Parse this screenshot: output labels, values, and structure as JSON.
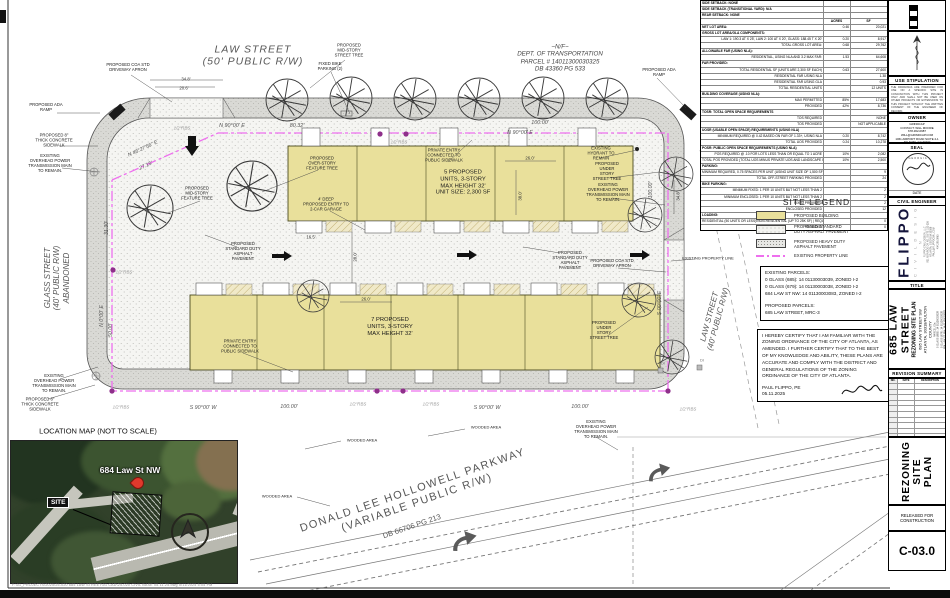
{
  "colors": {
    "building": "#e9e09b",
    "property_line": "#ee6fee",
    "pin": "#8e2f8a",
    "band": "#dadad6"
  },
  "site_table": {
    "rows": [
      {
        "l": "SIDE SETBACK: NONE",
        "a": "",
        "s": "",
        "h": 1
      },
      {
        "l": "SIDE SETBACK (TRANSITIONAL YARD): N/A",
        "a": "",
        "s": "",
        "h": 1
      },
      {
        "l": "REAR SETBACK: NONE",
        "a": "",
        "s": "",
        "h": 1
      },
      {
        "l": "",
        "a": "ACRES",
        "s": "SF",
        "h": 1,
        "c": 1
      },
      {
        "l": "NET LOT AREA:",
        "a": "0.46",
        "s": "20,021",
        "h": 1
      },
      {
        "l": "GROSS LOT AREA/GLA COMPONENTS:",
        "a": "",
        "s": "",
        "h": 1
      },
      {
        "l": "LAW 1: 190.3 AT X 25', LAW 2: 100 AT X 20', GLASS: 188.45 T X 20'",
        "a": "0.20",
        "s": "8,917"
      },
      {
        "l": "TOTAL GROSS LOT AREA:",
        "a": "0.68",
        "s": "29,762"
      },
      {
        "l": "ALLOWABLE FAR (USING NLA):",
        "a": "",
        "s": "",
        "h": 1
      },
      {
        "l": "RESIDENTIAL, USING NLA AND 3.2 MAX FAR:",
        "a": "1.53",
        "s": "64,608"
      },
      {
        "l": "FAR PROVIDED:",
        "a": "",
        "s": "",
        "h": 1
      },
      {
        "l": "TOTAL RESIDENTIAL SF (UNITS ARE 2,300 SF EACH)",
        "a": "0.63",
        "s": "27,600"
      },
      {
        "l": "RESIDENTIAL FAR USING NLA",
        "a": "",
        "s": "1.38"
      },
      {
        "l": "RESIDENTIAL FAR USING GLA",
        "a": "",
        "s": "0.93"
      },
      {
        "l": "TOTAL RESIDENTIAL UNITS",
        "a": "",
        "s": "12 UNITS"
      },
      {
        "l": "BUILDING COVERAGE (USING NLA):",
        "a": "",
        "s": "",
        "h": 1
      },
      {
        "l": "MAX PERMITTED",
        "a": "85%",
        "s": "17,683"
      },
      {
        "l": "PROVIDED",
        "a": "42%",
        "s": "8,736"
      },
      {
        "l": "TOSR: TOTAL OPEN SPACE REQUIREMENTS",
        "a": "",
        "s": "",
        "h": 1
      },
      {
        "l": "TOS REQUIRED",
        "a": "",
        "s": "NONE"
      },
      {
        "l": "TOS PROVIDED",
        "a": "",
        "s": "NOT APPLICABLE"
      },
      {
        "l": "UOSR (USABLE OPEN SPACE) REQUIREMENTS (USING NLA)",
        "a": "",
        "s": "",
        "h": 1
      },
      {
        "l": "MINIMUM REQUIRED @ 0.42 BASED ON FAR OF 1.33+, USING NLA",
        "a": "0.20",
        "s": "8,742"
      },
      {
        "l": "TOTAL UOS PROVIDED",
        "a": "0.24",
        "s": "10,278"
      },
      {
        "l": "POSR: PUBLIC OPEN SPACE REQUIREMENTS (USING NLA)",
        "a": "",
        "s": "",
        "h": 1
      },
      {
        "l": "POS REQUIRED @ .10 FOR LOTS LESS THAN OR EQUAL TO 1 ACRE",
        "a": "10%",
        "s": "2,082"
      },
      {
        "l": "TOTAL POS PROVIDED (TOTAL UOS MINUS PRIVATE UOS AND LANDSCAPE IN R.O.W.)",
        "a": "10%",
        "s": "2,500"
      },
      {
        "l": "PARKING:",
        "a": "",
        "s": "",
        "h": 1
      },
      {
        "l": "MINIMUM REQUIRED, 0.75 SPACES PER UNIT (USING UNIT SIZE OF 1,500 SF OR MORE)",
        "a": "",
        "s": "9"
      },
      {
        "l": "TOTAL OFF-STREET PARKING PROVIDED",
        "a": "",
        "s": "24"
      },
      {
        "l": "BIKE PARKING:",
        "a": "",
        "s": "",
        "h": 1
      },
      {
        "l": "MINIMUM FIXED: 1 PER 10 UNITS BUT NOT LESS THAN 2",
        "a": "",
        "s": "2"
      },
      {
        "l": "MINIMUM ENCLOSED: 1 PER 10 UNITS BUT NOT LESS THAN 2",
        "a": "",
        "s": "2"
      },
      {
        "l": "FIXED PROVIDED",
        "a": "",
        "s": "2"
      },
      {
        "l": "ENCLOSED PROVIDED",
        "a": "",
        "s": "12"
      },
      {
        "l": "LOADING:",
        "a": "",
        "s": "",
        "h": 1
      },
      {
        "l": "RESIDENTIAL (50 UNITS OR LESS)/NON-RESIDENTIAL (UP TO 25K SF) | REQUIRED",
        "a": "",
        "s": "0"
      },
      {
        "l": "PROVIDED",
        "a": "",
        "s": "0"
      }
    ]
  },
  "legend": {
    "title": "SITE LEGEND",
    "items": [
      {
        "label": "PROPOSED BUILDING"
      },
      {
        "label": "PROPOSED STANDARD\nDUTY ASPHALT PAVEMENT"
      },
      {
        "label": "PROPOSED HEAVY DUTY\nASPHALT PAVEMENT"
      },
      {
        "label": "EXISTING PROPERTY LINE"
      }
    ],
    "parcels": [
      "EXISTING PARCELS:",
      "0 GLASS (685): 14 01130003039, ZONED I-2",
      "0 GLASS (679): 14 01130003038, ZONED I-2",
      "684 LAW ST NW: 14 01130003083, ZONED I-2",
      "",
      "PROPOSED PARCELS:",
      "685 LAW STREET, MRC-3"
    ],
    "cert_text": "I HEREBY CERTIFY THAT I AM FAMILIAR WITH THE ZONING ORDINANCE OF THE CITY OF ATLANTA, AS AMENDED. I FURTHER CERTIFY THAT TO THE BEST OF MY KNOWLEDGE AND ABILITY, THESE PLANS ARE ACCURATE AND COMPLY WITH THE DISTRICT AND GENERAL REGULATIONS OF THE ZONING ORDINANCE OF THE CITY OF ATLANTA.",
    "cert_name": "PAUL FLIPPO, PE",
    "cert_date": "05.11.2025"
  },
  "location_map": {
    "title": "LOCATION MAP (NOT TO SCALE)",
    "street_label": "684 Law St NW",
    "site_label": "SITE",
    "file_path": "F:\\01_PROJECTS\\2025\\25-020      685 LAW STREET\\01 CAD\\25-020 CIVIL BASE 05.11.25.dwg      5/11/2025 5:05 PM"
  },
  "sidebar": {
    "graphic": {
      "label": "GRAPHIC",
      "ticks": "10      0",
      "scale": "1 inch = 20 ft."
    },
    "use_stipulation": {
      "title": "USE STIPULATION",
      "body": "THE DRAWINGS ARE PREPARED FOR USE ON A SPECIFIC SITE IN CONJUNCTION WITH THIS PROJECT ONLY AND SHALL NOT BE USED ON OTHER PROJECTS OR EXTENSIONS TO THIS PROJECT WITHOUT THE WRITTEN CONSENT OF THE ENGINEER OF RECORD."
    },
    "owner": {
      "title": "OWNER",
      "lines": [
        "GRINDCAP",
        "CONTACT: WILL MOORE",
        "678-362-0987",
        "WILL@GRINDCAP.COM",
        "1061 AIRPORT ROAD SUITE 2-1",
        "ATLANTA, GA 30344"
      ]
    },
    "seal": {
      "title": "SEAL",
      "state": "GEORGIA",
      "date_label": "DATE"
    },
    "engineer": {
      "title": "CIVIL ENGINEER",
      "firm": "FLIPPO",
      "sub": "C I V I L D E S I G N",
      "lines": [
        "FLIPPO CIVIL DESIGN, LLC",
        "931 MONROE DR NE, SUITE 102-326",
        "ATLANTA, GEORGIA 30308",
        "PAUL@FLIPPOCIVIL.COM",
        "404.295.0963"
      ]
    },
    "title_label": "TITLE",
    "project": {
      "name": "685 LAW STREET",
      "subtitle": "REZONING SITE PLAN",
      "address": "685 LAW STREET SW",
      "city": "ATLANTA, 30318/FULTON COUNTY",
      "parcels": [
        "PARCEL IDs:",
        "0 GLASS (685): 14 01130003039",
        "0 GLASS (679): 14 01130003038",
        "684 LAW ST NW: 14 01130003083"
      ]
    },
    "revision": {
      "title": "REVISION SUMMARY",
      "cols": [
        "NO.",
        "DATE",
        "DESCRIPTION"
      ]
    },
    "sheet_name": "REZONING\nSITE PLAN",
    "released": "RELEASED FOR\nCONSTRUCTION",
    "number": "C-03.0"
  },
  "plan": {
    "callouts": [
      {
        "n": "law-street-50-label",
        "t": "LAW STREET\n(50' PUBLIC R/W)",
        "x": 253,
        "y": 56,
        "fs": 10.5,
        "c": "#555",
        "i": 1,
        "ls": 1
      },
      {
        "n": "glass-street-label",
        "t": "GLASS STREET\n(40' PUBLIC R/W)\nABANDONED",
        "x": 57,
        "y": 278,
        "fs": 8,
        "c": "#555",
        "i": 1,
        "r": -90
      },
      {
        "n": "law-street-40-label",
        "t": "LAW STREET\n(40' PUBLIC R/W)",
        "x": 714,
        "y": 318,
        "fs": 8,
        "c": "#555",
        "i": 1,
        "r": -75
      },
      {
        "n": "dot-parcel-label",
        "t": "~N/F~\nDEPT. OF TRANSPORTATION\nPARCEL # 14011300030325\nDB 43360 PG 533",
        "x": 560,
        "y": 58,
        "fs": 6.2,
        "c": "#444",
        "i": 1
      },
      {
        "n": "parkway-label",
        "t": "DONALD LEE HOLLOWELL PARKWAY\n(VARIABLE PUBLIC R/W)",
        "x": 415,
        "y": 497,
        "fs": 11,
        "c": "#555",
        "r": -19,
        "ls": 1.5
      },
      {
        "n": "parkway-db-label",
        "t": "DB 66706 PG 213",
        "x": 412,
        "y": 527,
        "fs": 7.5,
        "c": "#555",
        "r": -19
      },
      {
        "n": "location-map-title",
        "t": "LOCATION MAP (NOT TO SCALE)",
        "x": 98,
        "y": 432,
        "fs": 7.5,
        "c": "#111"
      },
      {
        "n": "bearing-n90-1",
        "t": "N 90°00' E",
        "x": 232,
        "y": 126,
        "fs": 5.4,
        "c": "#555",
        "i": 1
      },
      {
        "n": "dist-8032",
        "t": "80.32'",
        "x": 297,
        "y": 126,
        "fs": 5.4,
        "c": "#555",
        "i": 1
      },
      {
        "n": "bearing-n90-2",
        "t": "N 90°00' E",
        "x": 520,
        "y": 133,
        "fs": 5.4,
        "c": "#555",
        "i": 1
      },
      {
        "n": "dist-100-top",
        "t": "100.00'",
        "x": 540,
        "y": 123,
        "fs": 5.4,
        "c": "#555",
        "i": 1
      },
      {
        "n": "bearing-n46",
        "t": "N 46°27'56\" E",
        "x": 143,
        "y": 149,
        "fs": 5.2,
        "c": "#555",
        "i": 1,
        "r": -25
      },
      {
        "n": "dist-2715",
        "t": "27.15'",
        "x": 146,
        "y": 166,
        "fs": 5.2,
        "c": "#555",
        "i": 1,
        "r": -25
      },
      {
        "n": "dist-3130",
        "t": "31.30'",
        "x": 107,
        "y": 228,
        "fs": 5.2,
        "c": "#555",
        "i": 1,
        "r": -90
      },
      {
        "n": "bearing-n0",
        "t": "N 0°00' E",
        "x": 102,
        "y": 316,
        "fs": 5.2,
        "c": "#555",
        "i": 1,
        "r": -90
      },
      {
        "n": "dist-5000",
        "t": "50.00'",
        "x": 111,
        "y": 330,
        "fs": 5.2,
        "c": "#555",
        "i": 1,
        "r": -90
      },
      {
        "n": "bearing-s90-1",
        "t": "S 90°00' W",
        "x": 203,
        "y": 408,
        "fs": 5.4,
        "c": "#555",
        "i": 1
      },
      {
        "n": "dist-100-sw1",
        "t": "100.00'",
        "x": 289,
        "y": 407,
        "fs": 5.4,
        "c": "#555",
        "i": 1
      },
      {
        "n": "bearing-s90-2",
        "t": "S 90°00' W",
        "x": 487,
        "y": 408,
        "fs": 5.4,
        "c": "#555",
        "i": 1
      },
      {
        "n": "dist-100-sw2",
        "t": "100.00'",
        "x": 580,
        "y": 407,
        "fs": 5.4,
        "c": "#555",
        "i": 1
      },
      {
        "n": "bearing-s0",
        "t": "S 00°00' E",
        "x": 660,
        "y": 303,
        "fs": 5.2,
        "c": "#555",
        "i": 1,
        "r": -90
      },
      {
        "n": "dist-100-east",
        "t": "100.00'",
        "x": 651,
        "y": 190,
        "fs": 5.2,
        "c": "#555",
        "i": 1,
        "r": -90
      },
      {
        "n": "rbs-1",
        "t": "1/2\"RBS",
        "x": 182,
        "y": 128,
        "fs": 4.4,
        "c": "#999",
        "i": 1
      },
      {
        "n": "rbs-2",
        "t": "1/2\"RBS",
        "x": 399,
        "y": 142,
        "fs": 4.4,
        "c": "#999",
        "i": 1
      },
      {
        "n": "rbs-3",
        "t": "1/2\"RBS",
        "x": 124,
        "y": 272,
        "fs": 4.4,
        "c": "#999",
        "i": 1
      },
      {
        "n": "rbs-4",
        "t": "1/2\"RBS",
        "x": 121,
        "y": 407,
        "fs": 4.4,
        "c": "#999",
        "i": 1
      },
      {
        "n": "rbs-5",
        "t": "1/2\"RBS",
        "x": 358,
        "y": 404,
        "fs": 4.4,
        "c": "#999",
        "i": 1
      },
      {
        "n": "rbs-6",
        "t": "1/2\"RBS",
        "x": 431,
        "y": 404,
        "fs": 4.4,
        "c": "#999",
        "i": 1
      },
      {
        "n": "rbs-7",
        "t": "1/2\"RBS",
        "x": 688,
        "y": 409,
        "fs": 4.4,
        "c": "#999",
        "i": 1
      },
      {
        "n": "dim-348-top",
        "t": "34.8'",
        "x": 186,
        "y": 79,
        "fs": 4.3,
        "c": "#333"
      },
      {
        "n": "dim-206",
        "t": "20.6'",
        "x": 184,
        "y": 88,
        "fs": 4.3,
        "c": "#333"
      },
      {
        "n": "dim-260-top",
        "t": "26.0'",
        "x": 530,
        "y": 158,
        "fs": 4.3,
        "c": "#333"
      },
      {
        "n": "dim-380",
        "t": "38.0'",
        "x": 520,
        "y": 196,
        "fs": 4.3,
        "c": "#333",
        "r": -90
      },
      {
        "n": "dim-165",
        "t": "16.5'",
        "x": 311,
        "y": 237,
        "fs": 4.3,
        "c": "#333"
      },
      {
        "n": "dim-280",
        "t": "28.0'",
        "x": 355,
        "y": 257,
        "fs": 4.3,
        "c": "#333",
        "r": -90
      },
      {
        "n": "dim-260-bot",
        "t": "26.0'",
        "x": 366,
        "y": 299,
        "fs": 4.3,
        "c": "#333"
      },
      {
        "n": "dim-348-right",
        "t": "34.8'",
        "x": 678,
        "y": 196,
        "fs": 4.3,
        "c": "#333",
        "r": -90
      },
      {
        "n": "di-1",
        "t": "DI",
        "x": 663,
        "y": 364,
        "fs": 4,
        "c": "#777"
      },
      {
        "n": "di-2",
        "t": "DI",
        "x": 702,
        "y": 361,
        "fs": 4,
        "c": "#777"
      },
      {
        "n": "callout-driveway-apron-top",
        "t": "PROPOSED COA STD\nDRIVEWAY APRON",
        "x": 128,
        "y": 68
      },
      {
        "n": "callout-midstory-street-tree",
        "t": "PROPOSED\nMID-STORY\nSTREET TREE",
        "x": 349,
        "y": 51
      },
      {
        "n": "callout-bike-parking",
        "t": "FIXED BIKE\nPARKING (2)",
        "x": 330,
        "y": 67
      },
      {
        "n": "callout-ada-ramp-left",
        "t": "PROPOSED ADA\nRAMP",
        "x": 46,
        "y": 108
      },
      {
        "n": "callout-ada-ramp-right",
        "t": "PROPOSED ADA\nRAMP",
        "x": 659,
        "y": 73
      },
      {
        "n": "callout-sidewalk-nw",
        "t": "PROPOSED 8\"\nTHICK CONCRETE\nSIDEWALK",
        "x": 54,
        "y": 141
      },
      {
        "n": "callout-power-nw",
        "t": "EXISTING\nOVERHEAD POWER\nTRANSMISSION MAIN\nTO REMAIN.",
        "x": 50,
        "y": 164
      },
      {
        "n": "callout-midstory-feature-tree",
        "t": "PROPOSED\nMID-STORY\nFEATURE TREE",
        "x": 197,
        "y": 194
      },
      {
        "n": "callout-overstory-feature-tree",
        "t": "PROPOSED\nOVER-STORY\nFEATURE TREE",
        "x": 322,
        "y": 164
      },
      {
        "n": "callout-private-entry-top",
        "t": "PRIVATE ENTRY\nCONNECTED TO\nPUBLIC SIDEWALK",
        "x": 444,
        "y": 156
      },
      {
        "n": "label-5-units",
        "t": "5 PROPOSED\nUNITS, 3-STORY\nMAX HEIGHT 32'\nUNIT SIZE: 2,300 SF",
        "x": 463,
        "y": 183,
        "fs": 5.8
      },
      {
        "n": "callout-hydrant",
        "t": "EXISTING\nHYDRANT TO\nREMAIN",
        "x": 601,
        "y": 154
      },
      {
        "n": "callout-understory-tree-ne",
        "t": "PROPOSED\nUNDER\nSTORY\nSTREET TREE",
        "x": 607,
        "y": 172
      },
      {
        "n": "callout-power-ne",
        "t": "EXISTING\nOVERHEAD POWER\nTRANSMISSION MAIN\nTO REMAIN.",
        "x": 608,
        "y": 193
      },
      {
        "n": "callout-garage-entry",
        "t": "4' DEEP\nPROPOSED ENTRY TO\n2-CAR GARAGE",
        "x": 326,
        "y": 205
      },
      {
        "n": "callout-asphalt-west",
        "t": "PROPOSED\nSTANDARD DUTY\nASPHALT\nPAVEMENT",
        "x": 243,
        "y": 252
      },
      {
        "n": "callout-asphalt-east",
        "t": "PROPOSED\nSTANDARD DUTY\nASPHALT\nPAVEMENT",
        "x": 570,
        "y": 261
      },
      {
        "n": "callout-driveway-apron-right",
        "t": "PROPOSED COA STD\nDRIVEWAY APRON",
        "x": 612,
        "y": 264
      },
      {
        "n": "callout-property-line",
        "t": "EXISTING PROPERTY LINE",
        "x": 708,
        "y": 259,
        "fs": 4
      },
      {
        "n": "label-7-units",
        "t": "7 PROPOSED\nUNITS, 3-STORY\nMAX HEIGHT 32'",
        "x": 390,
        "y": 327,
        "fs": 5.8
      },
      {
        "n": "callout-private-entry-bottom",
        "t": "PRIVATE ENTRY\nCONNECTED TO\nPUBLIC SIDEWALK",
        "x": 240,
        "y": 347
      },
      {
        "n": "callout-understory-tree-se",
        "t": "PROPOSED\nUNDER\nSTORY\nSTREET TREE",
        "x": 604,
        "y": 331
      },
      {
        "n": "callout-power-sw",
        "t": "EXISTING\nOVERHEAD POWER\nTRANSMISSION MAIN\nTO REMAIN.",
        "x": 54,
        "y": 384
      },
      {
        "n": "callout-sidewalk-sw",
        "t": "PROPOSED 8\"\nTHICK CONCRETE\nSIDEWALK",
        "x": 40,
        "y": 405
      },
      {
        "n": "wooded-area-1",
        "t": "WOODED AREA",
        "x": 362,
        "y": 441,
        "fs": 4
      },
      {
        "n": "wooded-area-2",
        "t": "WOODED AREA",
        "x": 486,
        "y": 428,
        "fs": 4
      },
      {
        "n": "wooded-area-3",
        "t": "WOODED AREA",
        "x": 277,
        "y": 497,
        "fs": 4
      },
      {
        "n": "callout-power-se",
        "t": "EXISTING\nOVERHEAD POWER\nTRANSMISSION MAIN\nTO REMAIN.",
        "x": 596,
        "y": 430
      }
    ]
  }
}
